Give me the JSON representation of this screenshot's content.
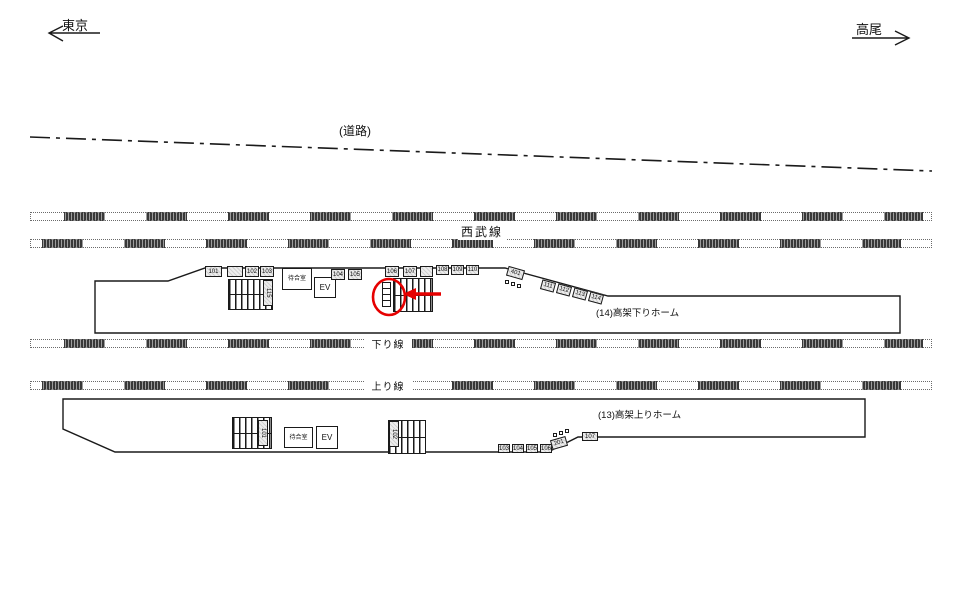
{
  "directions": {
    "left_label": "東京",
    "right_label": "高尾"
  },
  "road": {
    "label": "(道路)"
  },
  "lines": {
    "seibu": "西武線",
    "down": "下り線",
    "up": "上り線"
  },
  "platforms": {
    "down": {
      "label": "(14)高架下りホーム",
      "waiting_room": "待合室",
      "elevator": "EV"
    },
    "up": {
      "label": "(13)高架上りホーム",
      "waiting_room": "待合室",
      "elevator": "EV"
    }
  },
  "annotation": {
    "color": "#e60000",
    "shape": "circle-with-left-arrow"
  },
  "sign_boxes": [
    {
      "label": "101",
      "x": 205,
      "y": 266,
      "w": 17,
      "h": 11
    },
    {
      "label": "",
      "x": 227,
      "y": 266,
      "w": 16,
      "h": 11
    },
    {
      "label": "102",
      "x": 245,
      "y": 266,
      "w": 14,
      "h": 11
    },
    {
      "label": "103",
      "x": 260,
      "y": 266,
      "w": 14,
      "h": 11
    },
    {
      "label": "115",
      "x": 263,
      "y": 280,
      "w": 10,
      "h": 26,
      "orient": "v"
    },
    {
      "label": "104",
      "x": 331,
      "y": 269,
      "w": 14,
      "h": 11
    },
    {
      "label": "105",
      "x": 348,
      "y": 269,
      "w": 14,
      "h": 11
    },
    {
      "label": "106",
      "x": 385,
      "y": 266,
      "w": 14,
      "h": 11
    },
    {
      "label": "107",
      "x": 403,
      "y": 266,
      "w": 14,
      "h": 11
    },
    {
      "label": "",
      "x": 420,
      "y": 266,
      "w": 13,
      "h": 11
    },
    {
      "label": "108",
      "x": 436,
      "y": 265,
      "w": 13,
      "h": 10
    },
    {
      "label": "109",
      "x": 451,
      "y": 265,
      "w": 13,
      "h": 10
    },
    {
      "label": "110",
      "x": 466,
      "y": 265,
      "w": 13,
      "h": 10
    },
    {
      "label": "401",
      "x": 507,
      "y": 268,
      "w": 17,
      "h": 10,
      "rot": 16
    },
    {
      "label": "111",
      "x": 541,
      "y": 281,
      "w": 14,
      "h": 10,
      "rot": 15
    },
    {
      "label": "112",
      "x": 557,
      "y": 285,
      "w": 14,
      "h": 10,
      "rot": 15
    },
    {
      "label": "113",
      "x": 573,
      "y": 289,
      "w": 14,
      "h": 10,
      "rot": 15
    },
    {
      "label": "114",
      "x": 589,
      "y": 293,
      "w": 14,
      "h": 10,
      "rot": 15
    },
    {
      "label": "101",
      "x": 258,
      "y": 420,
      "w": 10,
      "h": 26,
      "orient": "v"
    },
    {
      "label": "102",
      "x": 389,
      "y": 421,
      "w": 10,
      "h": 26,
      "orient": "v"
    },
    {
      "label": "103",
      "x": 498,
      "y": 444,
      "w": 12,
      "h": 9
    },
    {
      "label": "104",
      "x": 512,
      "y": 444,
      "w": 12,
      "h": 9
    },
    {
      "label": "105",
      "x": 526,
      "y": 444,
      "w": 12,
      "h": 9
    },
    {
      "label": "106",
      "x": 540,
      "y": 444,
      "w": 12,
      "h": 9
    },
    {
      "label": "201",
      "x": 551,
      "y": 438,
      "w": 16,
      "h": 10,
      "rot": -16
    },
    {
      "label": "107",
      "x": 582,
      "y": 432,
      "w": 16,
      "h": 9
    }
  ],
  "marker_dots": [
    {
      "x": 505,
      "y": 280
    },
    {
      "x": 511,
      "y": 282
    },
    {
      "x": 517,
      "y": 284
    },
    {
      "x": 553,
      "y": 433
    },
    {
      "x": 559,
      "y": 431
    },
    {
      "x": 565,
      "y": 429
    }
  ]
}
